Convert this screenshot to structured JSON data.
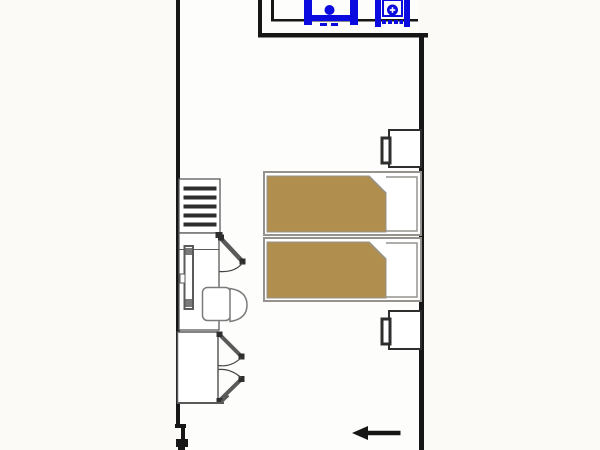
{
  "title": "apartment-floor-plan",
  "colors": {
    "floor": "#fbfaf7",
    "room_floor": "#fdfdfc",
    "wall": "#161616",
    "fixture_blue": "#0b0bdf",
    "bed_outline": "#96938e",
    "bed_blanket": "#b08e4e",
    "pillow_fill": "#ffffff",
    "furniture_dark": "#2e2e2e",
    "furniture_gray": "#5a5a5a",
    "furniture_light": "#7a7a7a",
    "arc_line": "#444444",
    "white": "#ffffff"
  },
  "plan": {
    "areas": [
      {
        "name": "bathroom",
        "position": "top-right"
      },
      {
        "name": "bedroom",
        "position": "main"
      }
    ],
    "fixtures": [
      {
        "name": "sink-left",
        "color": "#0b0bdf"
      },
      {
        "name": "sink-right",
        "color": "#0b0bdf"
      }
    ],
    "furniture": [
      {
        "name": "luggage-rack-with-slats",
        "slats": 5
      },
      {
        "name": "desk"
      },
      {
        "name": "radiator"
      },
      {
        "name": "desk-chair"
      },
      {
        "name": "interior-door-open"
      },
      {
        "name": "wardrobe-two-doors"
      },
      {
        "name": "twin-bed-upper",
        "blanket_color": "#b08e4e"
      },
      {
        "name": "twin-bed-lower",
        "blanket_color": "#b08e4e"
      },
      {
        "name": "nightstand-upper"
      },
      {
        "name": "nightstand-lower"
      }
    ],
    "annotations": [
      {
        "name": "entry-arrow",
        "direction": "left"
      }
    ]
  }
}
